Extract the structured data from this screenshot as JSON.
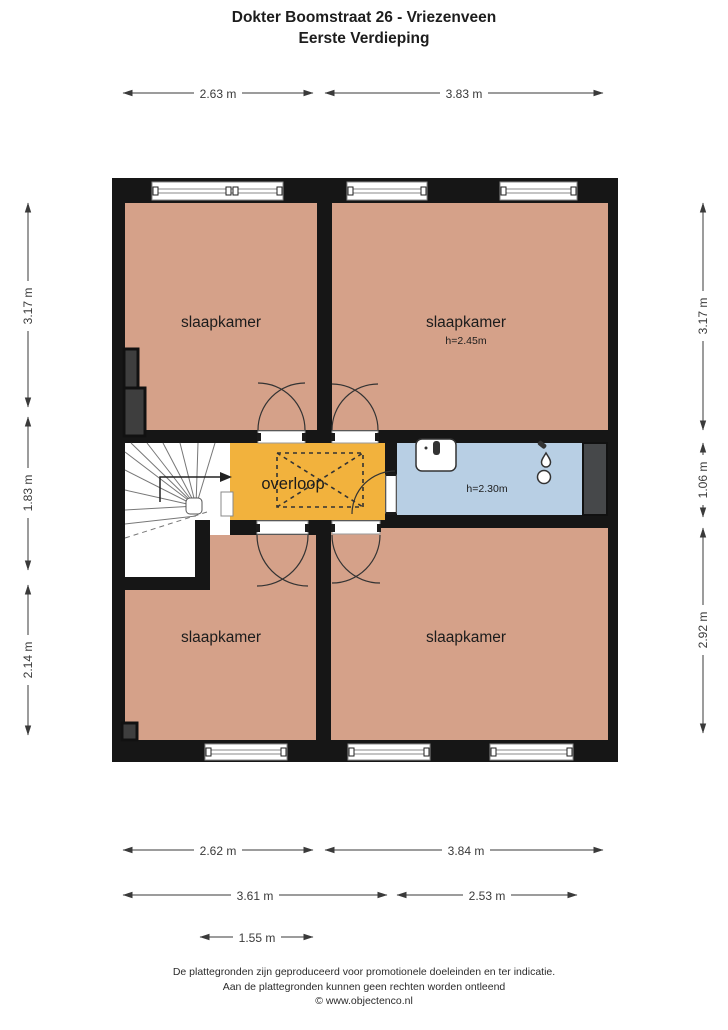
{
  "title": {
    "line1": "Dokter Boomstraat 26 - Vriezenveen",
    "line2": "Eerste Verdieping"
  },
  "rooms": {
    "bedroom_top_left": {
      "label": "slaapkamer"
    },
    "bedroom_top_right": {
      "label": "slaapkamer",
      "ceiling_height": "h=2.45m"
    },
    "landing": {
      "label": "overloop"
    },
    "bathroom": {
      "ceiling_height": "h=2.30m"
    },
    "bedroom_bottom_left": {
      "label": "slaapkamer"
    },
    "bedroom_bottom_right": {
      "label": "slaapkamer"
    }
  },
  "dimensions": {
    "top": [
      "2.63 m",
      "3.83 m"
    ],
    "left": [
      "3.17 m",
      "1.83 m",
      "2.14 m"
    ],
    "right": [
      "3.17 m",
      "1.06 m",
      "2.92 m"
    ],
    "bottom_row1": [
      "2.62 m",
      "3.84 m"
    ],
    "bottom_row2": [
      "3.61 m",
      "2.53 m"
    ],
    "bottom_row3": [
      "1.55 m"
    ]
  },
  "footer": {
    "line1": "De plattegronden zijn geproduceerd voor promotionele doeleinden en ter indicatie.",
    "line2": "Aan de plattegronden kunnen geen rechten worden ontleend",
    "line3": "© www.objectenco.nl"
  },
  "colors": {
    "room": "#d5a189",
    "landing": "#f2b23d",
    "bathroom": "#b8cfe4",
    "wall": "#161616",
    "duct": "#46484a",
    "niche": "#3e3e3e"
  }
}
